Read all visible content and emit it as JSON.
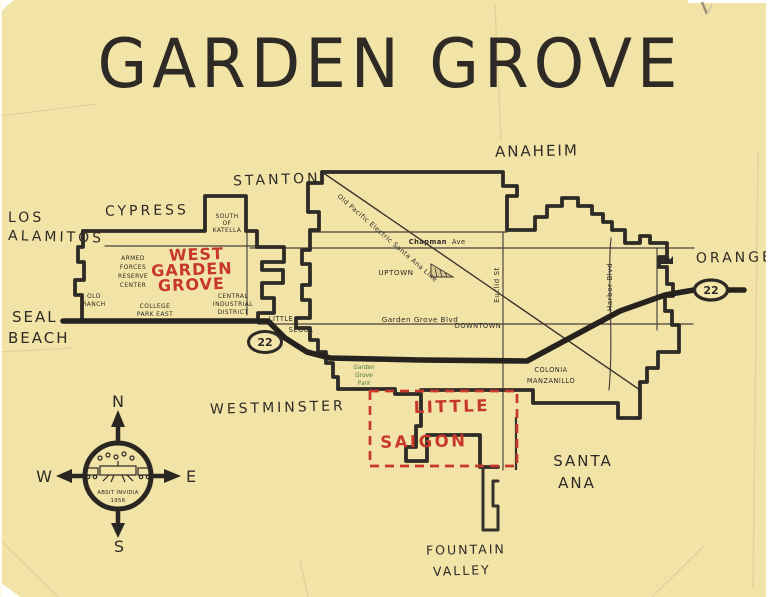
{
  "title": "GARDEN GROVE",
  "cities": {
    "anaheim": "ANAHEIM",
    "stanton": "STANTON",
    "cypress": "CYPRESS",
    "los_alamitos_line1": "LOS",
    "los_alamitos_line2": "ALAMITOS",
    "seal_beach_line1": "SEAL",
    "seal_beach_line2": "BEACH",
    "westminster": "WESTMINSTER",
    "orange": "ORANGE",
    "santa_ana_line1": "SANTA",
    "santa_ana_line2": "ANA",
    "fountain_valley_line1": "FOUNTAIN",
    "fountain_valley_line2": "VALLEY"
  },
  "districts": {
    "west_garden_grove_line1": "WEST",
    "west_garden_grove_line2": "GARDEN",
    "west_garden_grove_line3": "GROVE",
    "little_saigon_line1": "LITTLE",
    "little_saigon_line2": "SAIGON",
    "south_of_katella_line1": "SOUTH",
    "south_of_katella_line2": "OF",
    "south_of_katella_line3": "KATELLA",
    "armed_forces_line1": "ARMED",
    "armed_forces_line2": "FORCES",
    "armed_forces_line3": "RESERVE",
    "armed_forces_line4": "CENTER",
    "old_ranch_line1": "OLD",
    "old_ranch_line2": "RANCH",
    "college_park_line1": "COLLEGE",
    "college_park_line2": "PARK EAST",
    "central_industrial_line1": "CENTRAL",
    "central_industrial_line2": "INDUSTRIAL",
    "central_industrial_line3": "DISTRICT",
    "little_seoul_line1": "LITTLE",
    "little_seoul_line2": "SEOUL",
    "uptown": "UPTOWN",
    "downtown": "DOWNTOWN",
    "colonia_line1": "COLONIA",
    "colonia_line2": "MANZANILLO",
    "park_line1": "Garden",
    "park_line2": "Grove",
    "park_line3": "Park"
  },
  "roads": {
    "garden_grove_blvd": "Garden Grove Blvd",
    "chapman": "Chapman",
    "chapman_suffix": "Ave",
    "euclid_st": "Euclid St",
    "harbor_blvd": "Harbor Blvd",
    "rail_line": "Old Pacific Electric Santa Ana Line",
    "route_22": "22"
  },
  "compass": {
    "n": "N",
    "e": "E",
    "s": "S",
    "w": "W",
    "motto_line1": "ABSIT INVIDIA",
    "motto_line2": "1956"
  },
  "colors": {
    "paper": "#f4e6aa",
    "ink": "#2e2b26",
    "red": "#c8372b",
    "green": "#4a7a3a"
  }
}
